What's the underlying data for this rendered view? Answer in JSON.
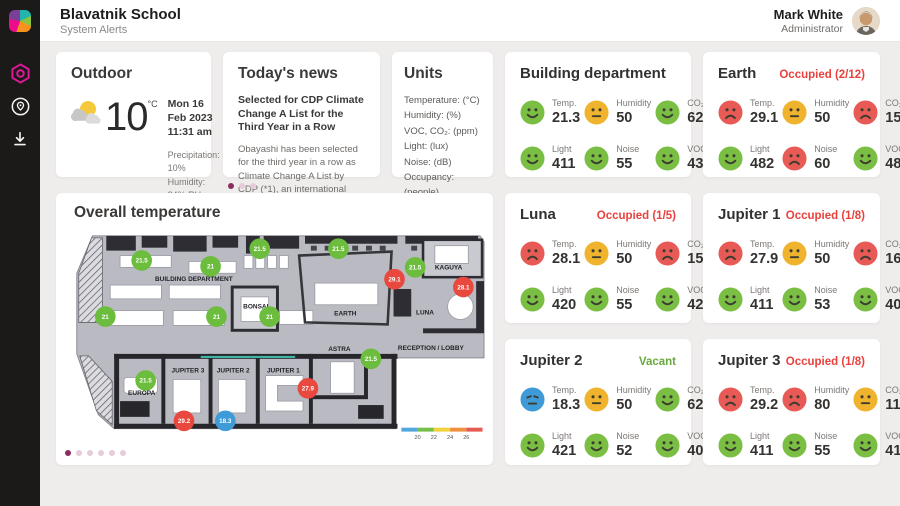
{
  "header": {
    "title": "Blavatnik School",
    "subtitle": "System Alerts",
    "user": {
      "name": "Mark White",
      "role": "Administrator"
    }
  },
  "sidebar": {
    "icons": [
      "brand-logo",
      "hexagon-alerts-icon",
      "map-pin-icon",
      "download-icon"
    ],
    "accent": "#e0189a"
  },
  "outdoor": {
    "title": "Outdoor",
    "temp": "10",
    "unit": "°C",
    "date": "Mon 16 Feb 2023",
    "time": "11:31 am",
    "details": [
      "Precipitation: 10%",
      "Humidity: 84% RH",
      "Wind speed: 4 Km/h"
    ]
  },
  "news": {
    "title": "Today's news",
    "headline": "Selected for CDP Climate Change A List for the Third Year in a Row",
    "body": "Obayashi has been selected for the third year in a row as Climate Change A List by CDP (*1), an international non-profit organization. CDP annually",
    "page_dots": {
      "count": 3,
      "active": 0
    }
  },
  "units": {
    "title": "Units",
    "items": [
      "Temperature: (°C)",
      "Humidity: (%)",
      "VOC, CO₂: (ppm)",
      "Light: (lux)",
      "Noise: (dB)",
      "Occupancy: (people)"
    ]
  },
  "rooms": [
    {
      "id": "building-department",
      "title": "Building department",
      "status": "",
      "status_color": "",
      "metrics": [
        {
          "label": "Temp.",
          "value": "21.3",
          "mood": "happy"
        },
        {
          "label": "Humidity",
          "value": "50",
          "mood": "neutral"
        },
        {
          "label": "CO₂",
          "value": "622",
          "mood": "happy"
        },
        {
          "label": "Light",
          "value": "411",
          "mood": "happy"
        },
        {
          "label": "Noise",
          "value": "55",
          "mood": "happy"
        },
        {
          "label": "VOC",
          "value": "430",
          "mood": "happy"
        }
      ]
    },
    {
      "id": "earth",
      "title": "Earth",
      "status": "Occupied (2/12)",
      "status_color": "red",
      "metrics": [
        {
          "label": "Temp.",
          "value": "29.1",
          "mood": "sad"
        },
        {
          "label": "Humidity",
          "value": "50",
          "mood": "neutral"
        },
        {
          "label": "CO₂",
          "value": "1530",
          "mood": "sad"
        },
        {
          "label": "Light",
          "value": "482",
          "mood": "happy"
        },
        {
          "label": "Noise",
          "value": "60",
          "mood": "sad"
        },
        {
          "label": "VOC",
          "value": "480",
          "mood": "happy"
        }
      ]
    },
    {
      "id": "luna",
      "title": "Luna",
      "status": "Occupied (1/5)",
      "status_color": "red",
      "metrics": [
        {
          "label": "Temp.",
          "value": "28.1",
          "mood": "sad"
        },
        {
          "label": "Humidity",
          "value": "50",
          "mood": "neutral"
        },
        {
          "label": "CO₂",
          "value": "1510",
          "mood": "sad"
        },
        {
          "label": "Light",
          "value": "420",
          "mood": "happy"
        },
        {
          "label": "Noise",
          "value": "55",
          "mood": "happy"
        },
        {
          "label": "VOC",
          "value": "421",
          "mood": "happy"
        }
      ]
    },
    {
      "id": "jupiter-1",
      "title": "Jupiter 1",
      "status": "Occupied (1/8)",
      "status_color": "red",
      "metrics": [
        {
          "label": "Temp.",
          "value": "27.9",
          "mood": "sad"
        },
        {
          "label": "Humidity",
          "value": "50",
          "mood": "neutral"
        },
        {
          "label": "CO₂",
          "value": "1600",
          "mood": "sad"
        },
        {
          "label": "Light",
          "value": "411",
          "mood": "happy"
        },
        {
          "label": "Noise",
          "value": "53",
          "mood": "happy"
        },
        {
          "label": "VOC",
          "value": "407",
          "mood": "happy"
        }
      ]
    },
    {
      "id": "jupiter-2",
      "title": "Jupiter 2",
      "status": "Vacant",
      "status_color": "green",
      "metrics": [
        {
          "label": "Temp.",
          "value": "18.3",
          "mood": "cold"
        },
        {
          "label": "Humidity",
          "value": "50",
          "mood": "neutral"
        },
        {
          "label": "CO₂",
          "value": "621",
          "mood": "happy"
        },
        {
          "label": "Light",
          "value": "421",
          "mood": "happy"
        },
        {
          "label": "Noise",
          "value": "52",
          "mood": "happy"
        },
        {
          "label": "VOC",
          "value": "407",
          "mood": "happy"
        }
      ]
    },
    {
      "id": "jupiter-3",
      "title": "Jupiter 3",
      "status": "Occupied (1/8)",
      "status_color": "red",
      "metrics": [
        {
          "label": "Temp.",
          "value": "29.2",
          "mood": "sad"
        },
        {
          "label": "Humidity",
          "value": "80",
          "mood": "sad"
        },
        {
          "label": "CO₂",
          "value": "1100",
          "mood": "neutral"
        },
        {
          "label": "Light",
          "value": "411",
          "mood": "happy"
        },
        {
          "label": "Noise",
          "value": "55",
          "mood": "happy"
        },
        {
          "label": "VOC",
          "value": "411",
          "mood": "happy"
        }
      ]
    }
  ],
  "floorplan": {
    "title": "Overall temperature",
    "labels": [
      {
        "text": "BUILDING DEPARTMENT",
        "x": 133,
        "y": 54
      },
      {
        "text": "BONSAI",
        "x": 196,
        "y": 82
      },
      {
        "text": "EARTH",
        "x": 287,
        "y": 89
      },
      {
        "text": "KAGUYA",
        "x": 392,
        "y": 42
      },
      {
        "text": "LUNA",
        "x": 368,
        "y": 88
      },
      {
        "text": "JUPITER 3",
        "x": 127,
        "y": 147
      },
      {
        "text": "JUPITER 2",
        "x": 173,
        "y": 147
      },
      {
        "text": "JUPITER 1",
        "x": 224,
        "y": 147
      },
      {
        "text": "EUROPA",
        "x": 80,
        "y": 170
      },
      {
        "text": "ASTRA",
        "x": 281,
        "y": 125
      },
      {
        "text": "RECEPTION / LOBBY",
        "x": 374,
        "y": 124
      }
    ],
    "badges": [
      {
        "value": "21.5",
        "mood": "green",
        "x": 80,
        "y": 33
      },
      {
        "value": "21",
        "mood": "green",
        "x": 150,
        "y": 39
      },
      {
        "value": "21.5",
        "mood": "green",
        "x": 200,
        "y": 21
      },
      {
        "value": "21.5",
        "mood": "green",
        "x": 280,
        "y": 21
      },
      {
        "value": "21.5",
        "mood": "green",
        "x": 358,
        "y": 40
      },
      {
        "value": "29.1",
        "mood": "red",
        "x": 337,
        "y": 52
      },
      {
        "value": "28.1",
        "mood": "red",
        "x": 407,
        "y": 60
      },
      {
        "value": "21",
        "mood": "green",
        "x": 43,
        "y": 90
      },
      {
        "value": "21",
        "mood": "green",
        "x": 156,
        "y": 90
      },
      {
        "value": "21",
        "mood": "green",
        "x": 210,
        "y": 90
      },
      {
        "value": "21.5",
        "mood": "green",
        "x": 313,
        "y": 133
      },
      {
        "value": "21.5",
        "mood": "green",
        "x": 84,
        "y": 155
      },
      {
        "value": "27.9",
        "mood": "red",
        "x": 249,
        "y": 163
      },
      {
        "value": "29.2",
        "mood": "red",
        "x": 123,
        "y": 196
      },
      {
        "value": "18.3",
        "mood": "blue",
        "x": 165,
        "y": 196
      }
    ],
    "legend": {
      "ticks": [
        "20",
        "22",
        "24",
        "26"
      ],
      "colors": [
        "#52a7dd",
        "#76bf4b",
        "#f2d23c",
        "#ef8f3f",
        "#e55a52"
      ]
    },
    "page_dots": {
      "count": 6,
      "active": 0
    }
  },
  "colors": {
    "accent_magenta": "#e0189a",
    "status_red": "#e9413d",
    "status_green": "#69a73f",
    "face_happy": "#7abf44",
    "face_neutral": "#f0b32e",
    "face_sad": "#e85a55",
    "face_cold": "#3e9bd8",
    "badge_green": "#6cbc3e",
    "badge_red": "#e8483e",
    "badge_blue": "#3e9bd8"
  }
}
